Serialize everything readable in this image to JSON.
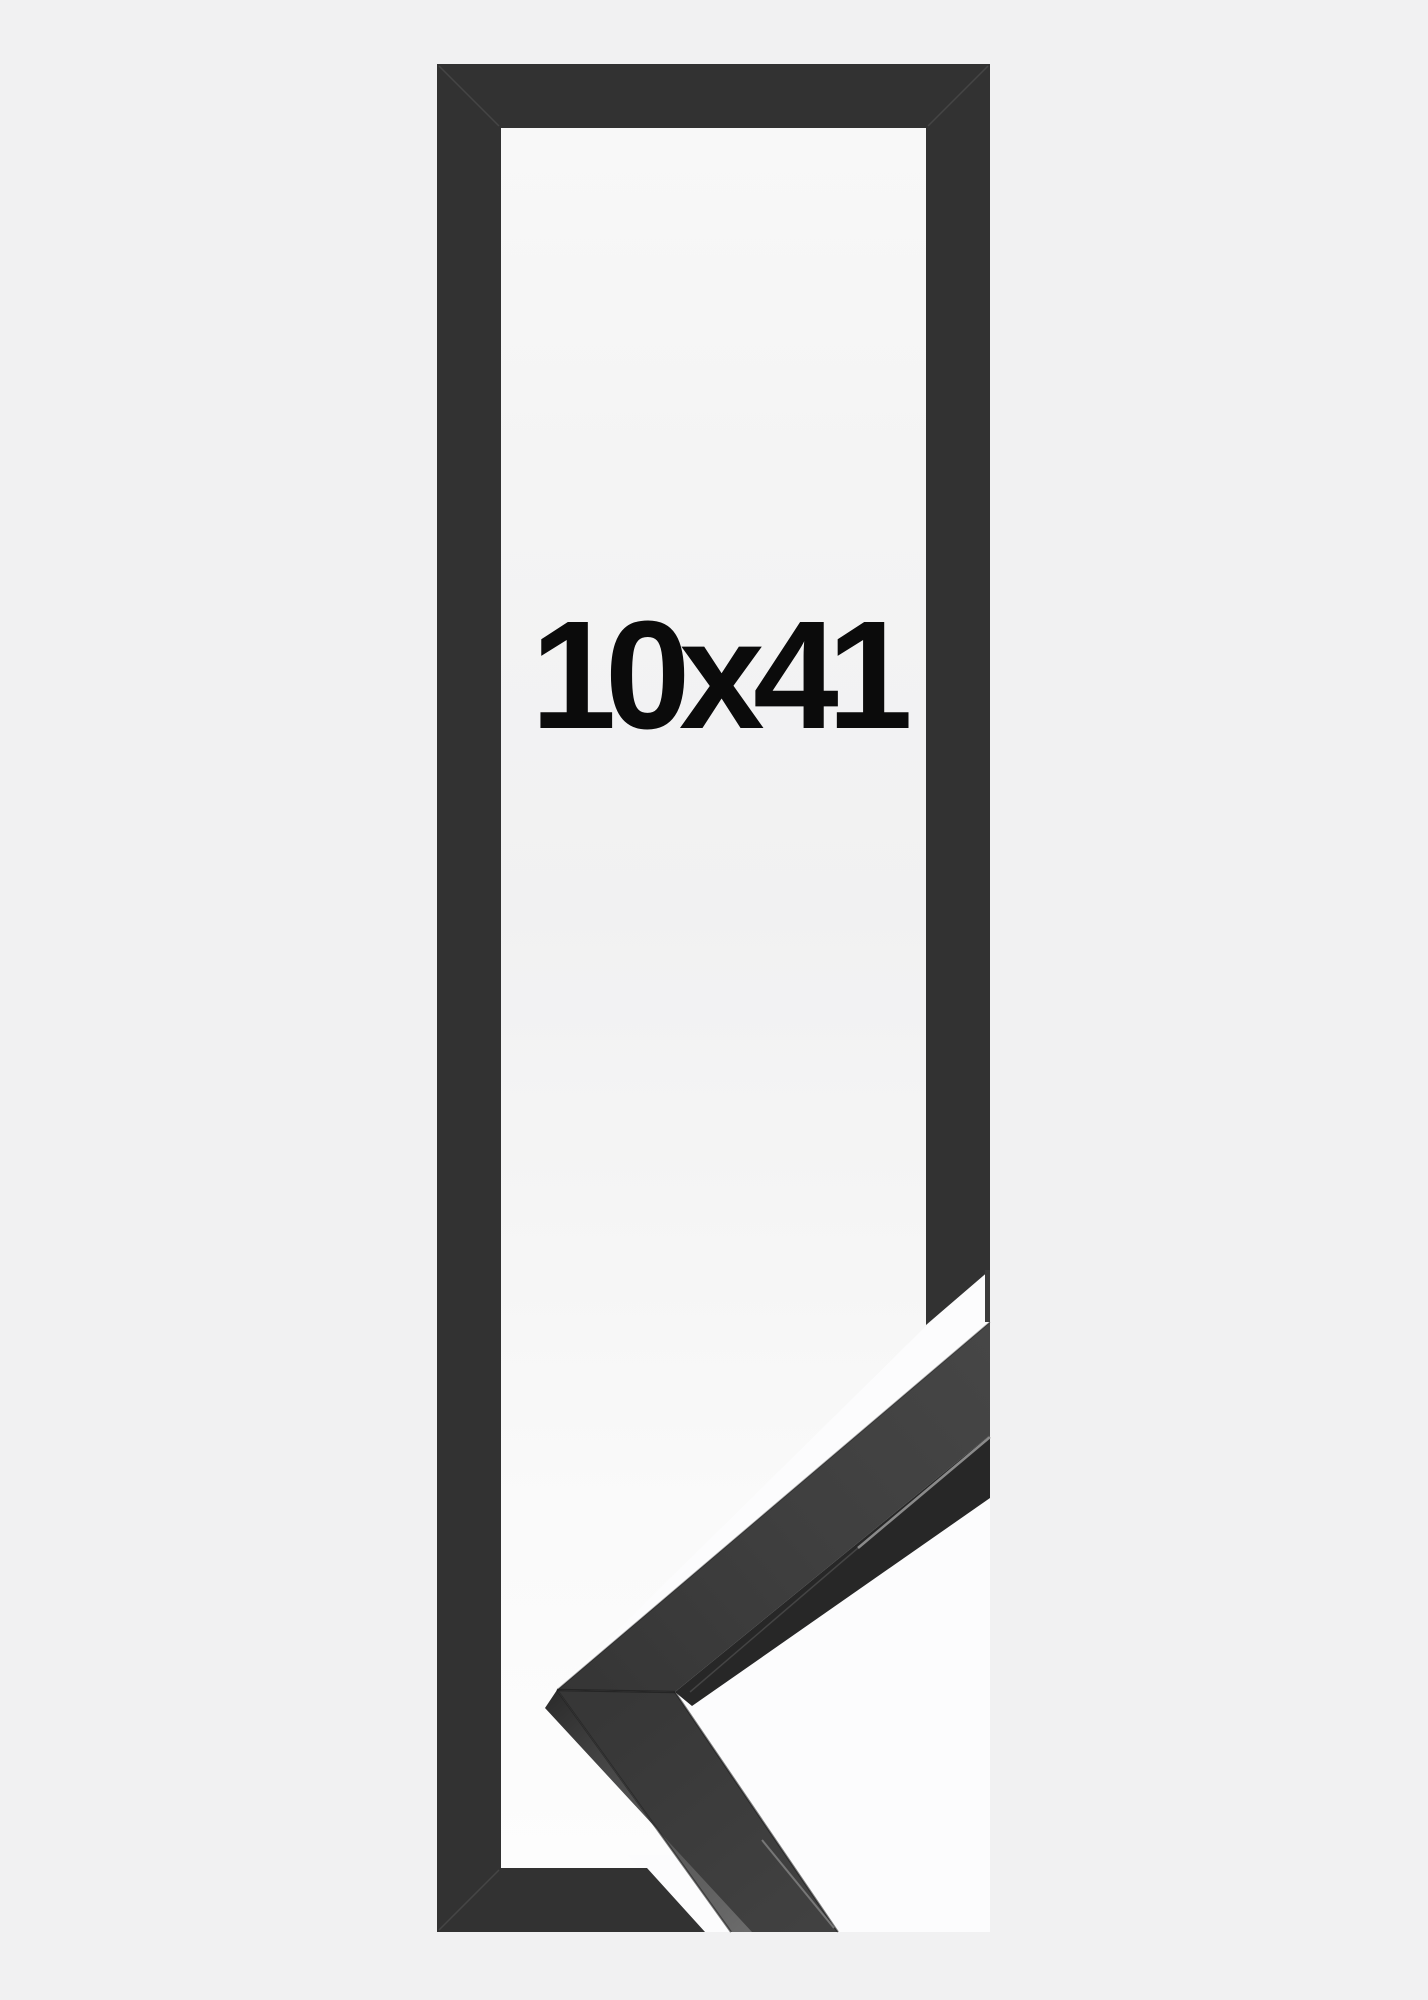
{
  "product": {
    "size_label": "10x41"
  },
  "colors": {
    "background": "#f1f1f2",
    "frame": "#323232",
    "label": "#0b0b0b",
    "overlay_white": "#fcfcfd",
    "sample_inner_face": "#272727"
  }
}
